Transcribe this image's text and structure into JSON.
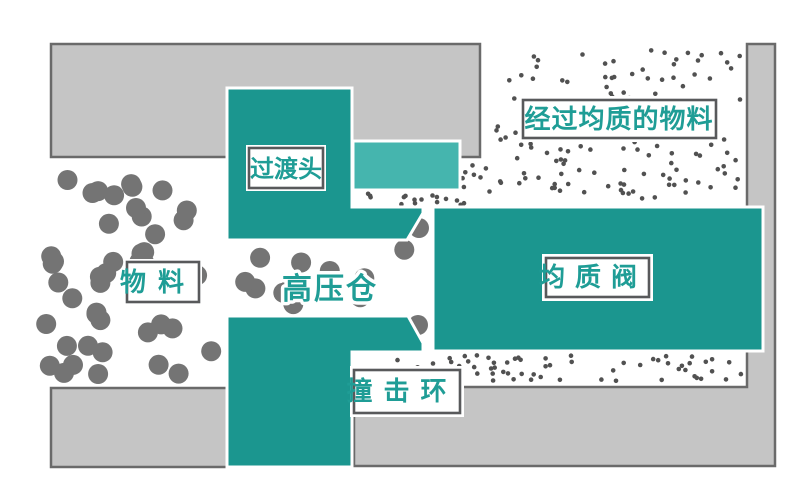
{
  "diagram": {
    "labels": {
      "transition_head": "过渡头",
      "material": "物料",
      "high_pressure_chamber": "高压仓",
      "homogenizing_valve": "均质阀",
      "impact_ring": "撞击环",
      "homogenized_material": "经过均质的物料"
    },
    "colors": {
      "teal": "#1b968f",
      "light_teal": "#45b5ae",
      "block_gray": "#c5c5c5",
      "block_border": "#6a6a6a",
      "label_border": "#58595b",
      "label_fill": "#ffffff",
      "label_text_teal": "#1f9d96",
      "big_dot": "#747474",
      "small_dot": "#515151",
      "background": "#ffffff"
    },
    "particles": {
      "seed": 7,
      "big": {
        "r": 10,
        "fill": "#747474",
        "regions": [
          {
            "x": 46,
            "y": 172,
            "w": 168,
            "h": 202,
            "count": 45
          },
          {
            "x": 240,
            "y": 246,
            "w": 168,
            "h": 62,
            "count": 12
          }
        ],
        "extra": [
          [
            419,
            228
          ],
          [
            418,
            325
          ]
        ]
      },
      "small": {
        "r": 2.3,
        "fill": "#515151",
        "regions": [
          {
            "x": 488,
            "y": 50,
            "w": 254,
            "h": 150,
            "count": 135
          },
          {
            "x": 352,
            "y": 193,
            "w": 130,
            "h": 12,
            "count": 16
          },
          {
            "x": 462,
            "y": 158,
            "w": 24,
            "h": 35,
            "count": 7
          },
          {
            "x": 352,
            "y": 355,
            "w": 390,
            "h": 26,
            "count": 62
          }
        ],
        "extra": []
      }
    }
  }
}
